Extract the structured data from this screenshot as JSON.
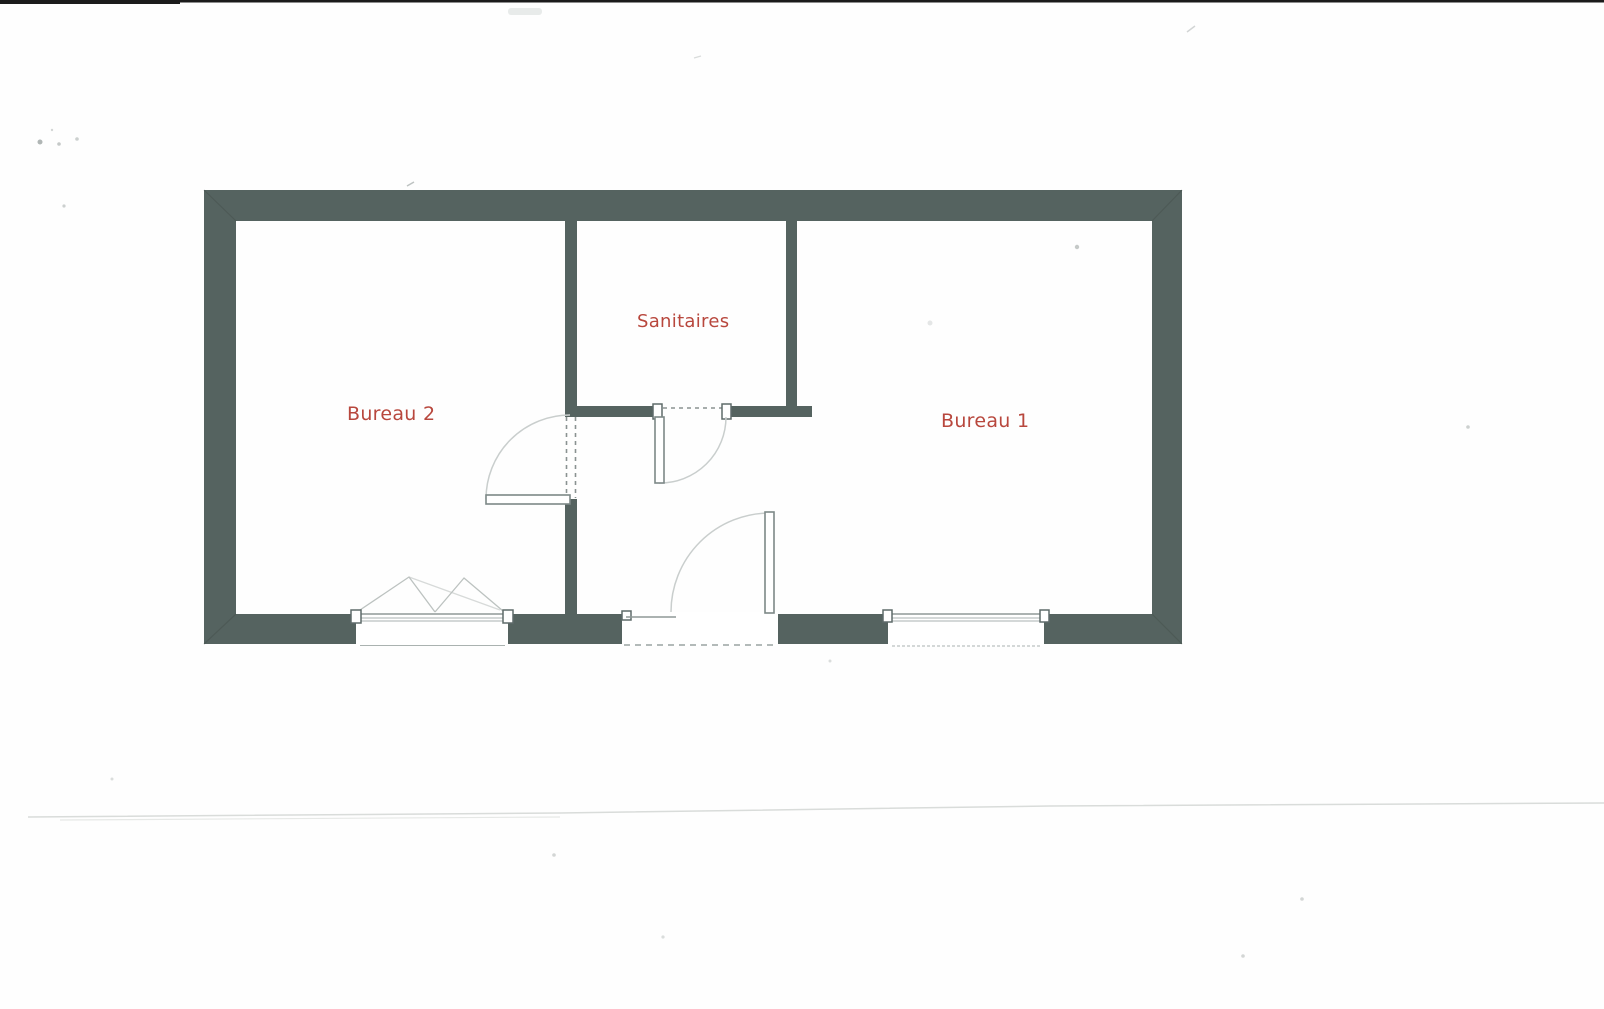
{
  "document": {
    "kind": "scanned-floor-plan"
  },
  "floor_plan": {
    "rooms": [
      {
        "id": "bureau-2",
        "label": "Bureau 2"
      },
      {
        "id": "sanitaires",
        "label": "Sanitaires"
      },
      {
        "id": "bureau-1",
        "label": "Bureau 1"
      }
    ],
    "symbols": {
      "doors": [
        "bureau-2-door",
        "sanitaires-door",
        "entrance-door"
      ],
      "windows": [
        "bureau-2-casement-window",
        "bureau-1-window"
      ]
    }
  },
  "colors": {
    "wall": "#556360",
    "wall_seam": "#47524e",
    "room_label": "#b8473d",
    "door_arc": "#c9cecd",
    "scan_edge": "#1b1b1b",
    "scan_line": "#d9dcda"
  }
}
